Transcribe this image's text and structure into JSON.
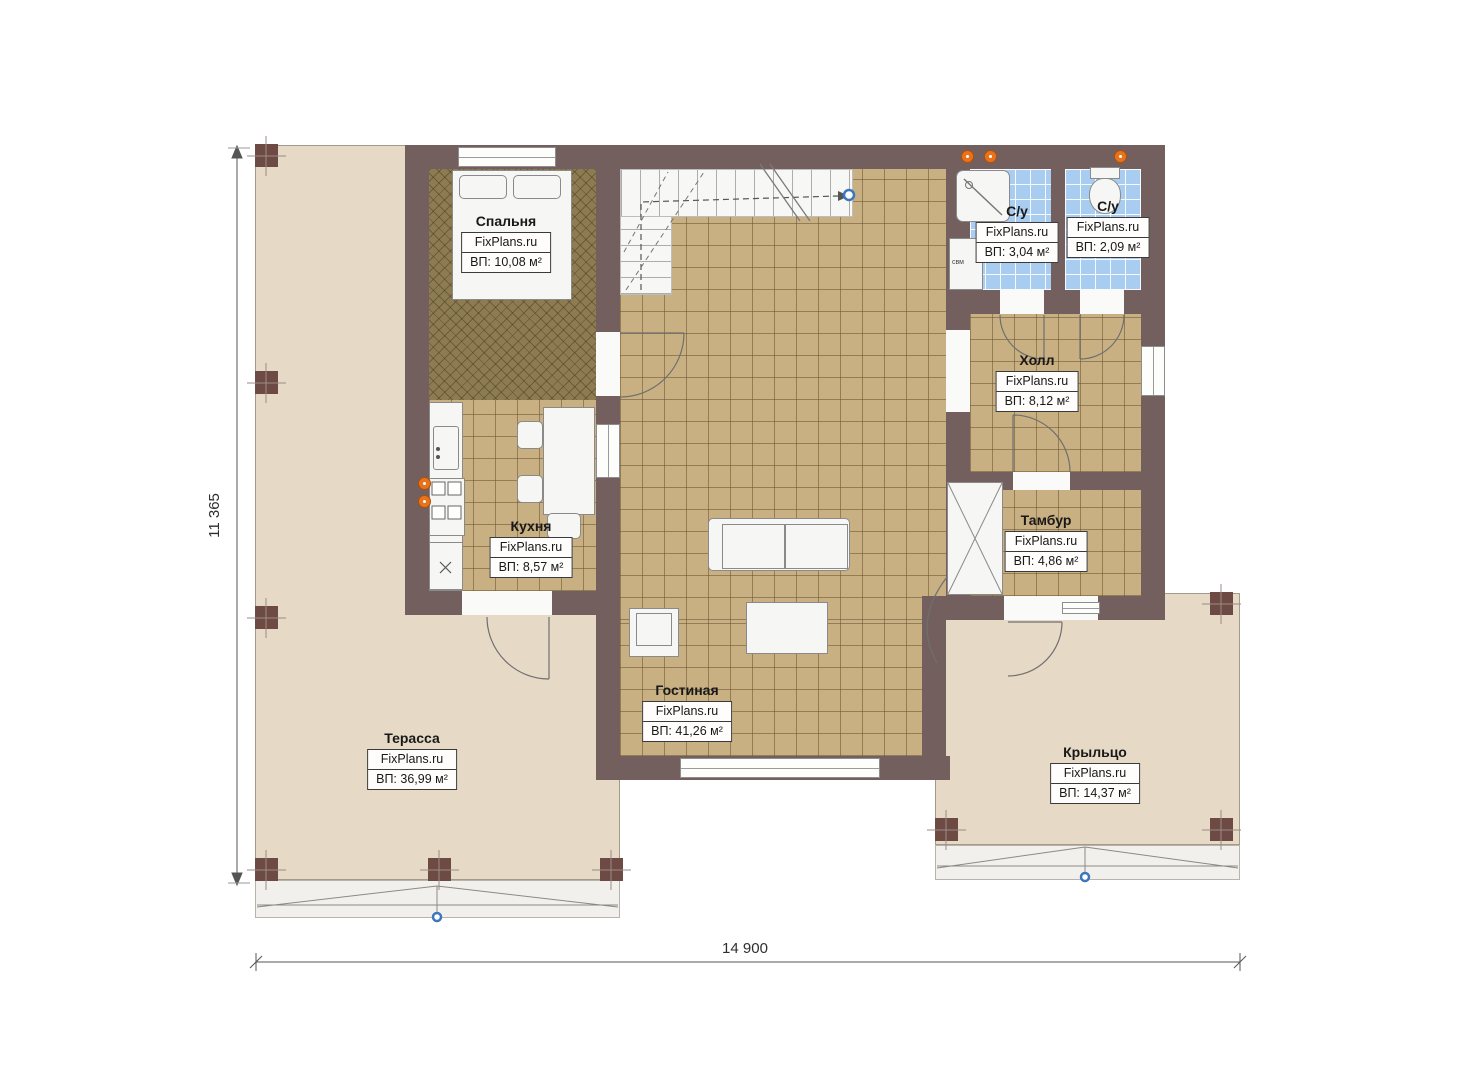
{
  "brand": "FixPlans.ru",
  "rooms": [
    {
      "id": "bedroom",
      "name": "Спальня",
      "area": "ВП: 10,08 м²"
    },
    {
      "id": "bath1",
      "name": "С/у",
      "area": "ВП: 3,04 м²"
    },
    {
      "id": "bath2",
      "name": "С/у",
      "area": "ВП: 2,09 м²"
    },
    {
      "id": "hall",
      "name": "Холл",
      "area": "ВП: 8,12 м²"
    },
    {
      "id": "kitchen",
      "name": "Кухня",
      "area": "ВП: 8,57 м²"
    },
    {
      "id": "tambour",
      "name": "Тамбур",
      "area": "ВП: 4,86 м²"
    },
    {
      "id": "living",
      "name": "Гостиная",
      "area": "ВП: 41,26 м²"
    },
    {
      "id": "terrace",
      "name": "Терасса",
      "area": "ВП: 36,99 м²"
    },
    {
      "id": "porch",
      "name": "Крыльцо",
      "area": "ВП: 14,37 м²"
    }
  ],
  "dimensions": {
    "height_label": "11 365",
    "width_label": "14 900"
  },
  "annotations": {
    "washer": "свм"
  },
  "colors": {
    "wall": "#73605e",
    "post": "#6d4b44",
    "floor_tile": "#c9b083",
    "floor_bedroom": "#8d7b52",
    "floor_bath": "#a9cdf1",
    "deck": "#e6dac7",
    "fixture_orange": "#e8731c",
    "marker_blue": "#3b76c1"
  }
}
